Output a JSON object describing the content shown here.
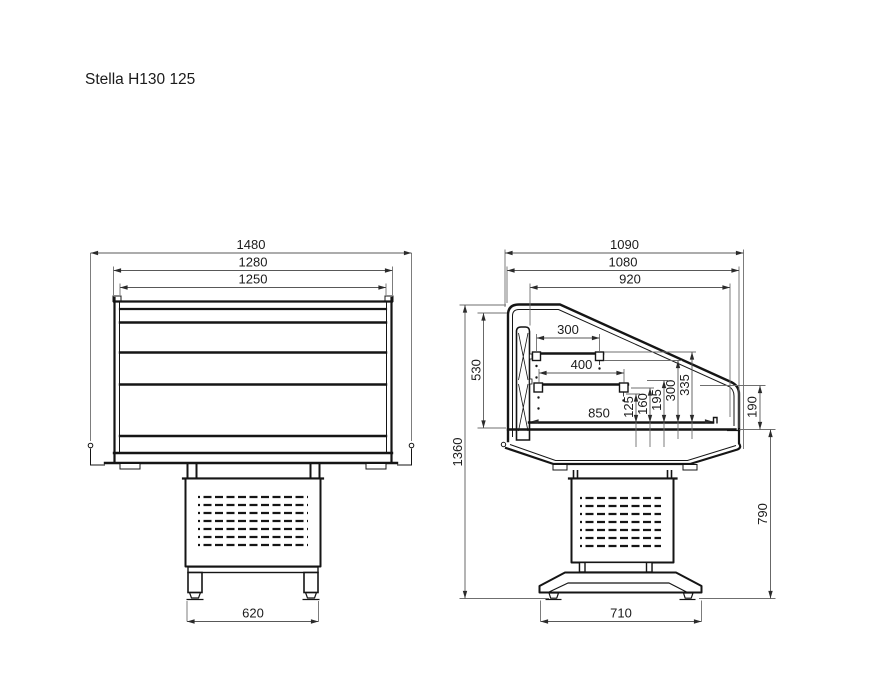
{
  "title": "Stella H130 125",
  "front_view": {
    "dim_overall_width": "1480",
    "dim_body_width": "1280",
    "dim_inner_width": "1250",
    "dim_feet_width": "620"
  },
  "side_view": {
    "dim_overall_depth": "1090",
    "dim_case_depth": "1080",
    "dim_canopy_depth": "920",
    "dim_upper_shelf_depth": "300",
    "dim_lower_shelf_depth": "400",
    "dim_deck_depth": "850",
    "dim_heights": [
      "125",
      "160",
      "195",
      "300",
      "335"
    ],
    "dim_inner_height": "530",
    "dim_overall_height": "1360",
    "dim_front_glass_height": "190",
    "dim_understructure_height": "790",
    "dim_base_depth": "710"
  }
}
